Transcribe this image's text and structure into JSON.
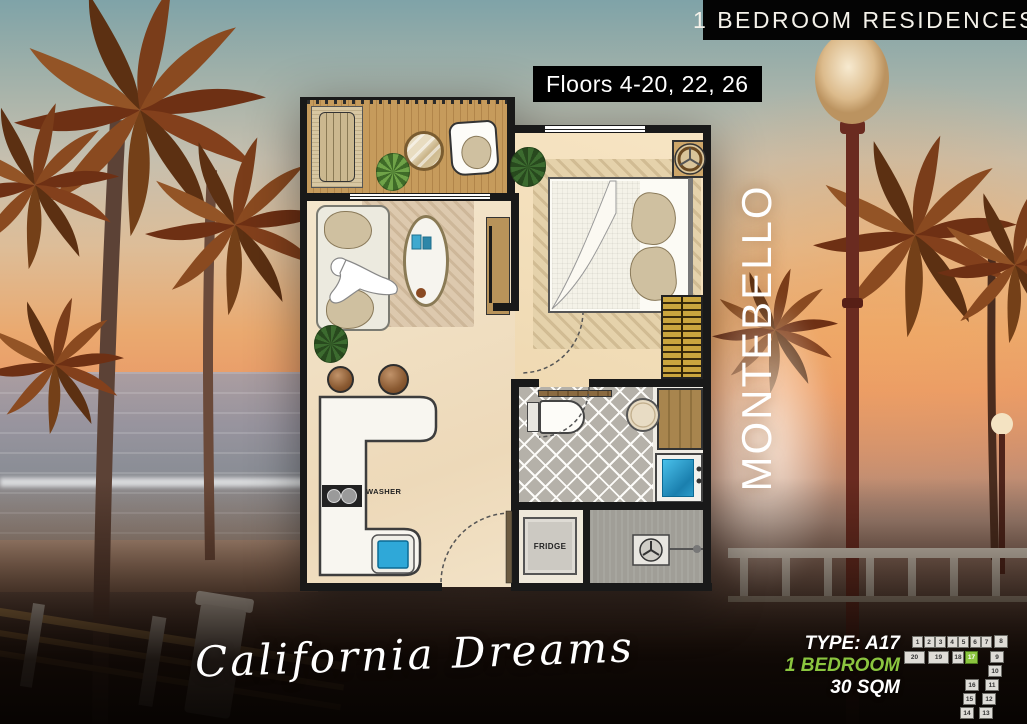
{
  "header": {
    "residences_label": "1 BEDROOM RESIDENCES",
    "floors_label": "Floors 4-20, 22, 26"
  },
  "building_name": "MONTEBELLO",
  "project_script": "California Dreams",
  "unit_info": {
    "type_label": "TYPE: A17",
    "bedroom_label": "1 BEDROOM",
    "area_label": "30 SQM"
  },
  "plan_labels": {
    "washer": "WASHER",
    "fridge": "FRIDGE"
  },
  "unit_locator": {
    "highlighted_unit": "17",
    "cells": [
      {
        "label": "1"
      },
      {
        "label": "2"
      },
      {
        "label": "3"
      },
      {
        "label": "4"
      },
      {
        "label": "5"
      },
      {
        "label": "6"
      },
      {
        "label": "7"
      },
      {
        "label": "8"
      },
      {
        "label": "20"
      },
      {
        "label": "19"
      },
      {
        "label": "18"
      },
      {
        "label": "17",
        "highlight": true
      },
      {
        "label": "9"
      },
      {
        "label": "10"
      },
      {
        "label": "11"
      },
      {
        "label": "12"
      },
      {
        "label": "13"
      },
      {
        "label": "16"
      },
      {
        "label": "15"
      },
      {
        "label": "14"
      }
    ]
  },
  "colors": {
    "accent_green": "#8bc53f",
    "banner_bg": "#000000",
    "text_white": "#ffffff"
  }
}
